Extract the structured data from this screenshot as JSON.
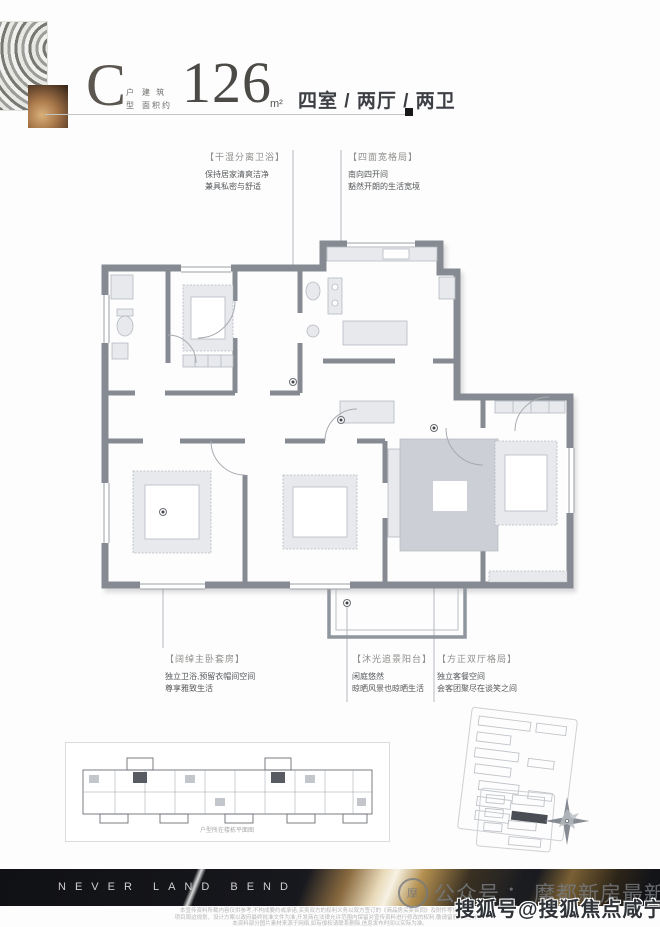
{
  "header": {
    "type_letter": "C",
    "type_top": "户",
    "type_bottom": "型",
    "area_label_line1": "建 筑",
    "area_label_line2": "面积约",
    "area_value": "126",
    "area_unit": "m²",
    "layout": "四室 / 两厅 / 两卫"
  },
  "callouts_top": [
    {
      "title": "【干湿分离卫浴】",
      "line1": "保持居家清爽洁净",
      "line2": "兼具私密与舒适"
    },
    {
      "title": "【四面宽格局】",
      "line1": "南向四开间",
      "line2": "豁然开朗的生活宽境"
    }
  ],
  "callouts_bottom": [
    {
      "title": "【阔绰主卧套房】",
      "line1": "独立卫浴,预留衣帽间空间",
      "line2": "尊享雅致生活"
    },
    {
      "title": "【沐光追景阳台】",
      "line1": "闲庭悠然",
      "line2": "晾晒风景也晾晒生活"
    },
    {
      "title": "【方正双厅格局】",
      "line1": "独立客餐空间",
      "line2": "会客团聚尽在谈笑之间"
    }
  ],
  "siteplan": {
    "caption": "户型所在楼栋平面图"
  },
  "banner": {
    "text": "NEVER LAND BEND"
  },
  "disclaimer": {
    "line1": "本宣传资料所载内容仅供参考,不构成要约或承诺,买卖双方的权利义务以双方签订的《商品房买卖合同》及附件等协议为准。",
    "line2": "项目周边规划、设计方案以政府最终批准文件为准,开发商在法律允许范围内保留对宣传资料进行修改的权利,敬请留意最新资料。",
    "line3": "本资料部分图片素材来源于网络,如有侵权请联系删除,信息发布时间以实际为准。"
  },
  "watermarks": {
    "wechat_label": "公众号",
    "wechat_sep": "：",
    "wechat_name": "摩都新房最新信息",
    "seal_glyph": "摩",
    "sohu": "搜狐号@搜狐焦点咸宁站"
  },
  "colors": {
    "wall": "#868b93",
    "furniture": "#e7e9ec",
    "rug": "#ccd0d6",
    "accent_dark": "#17181a",
    "banner_gold": "#c9a36b"
  }
}
